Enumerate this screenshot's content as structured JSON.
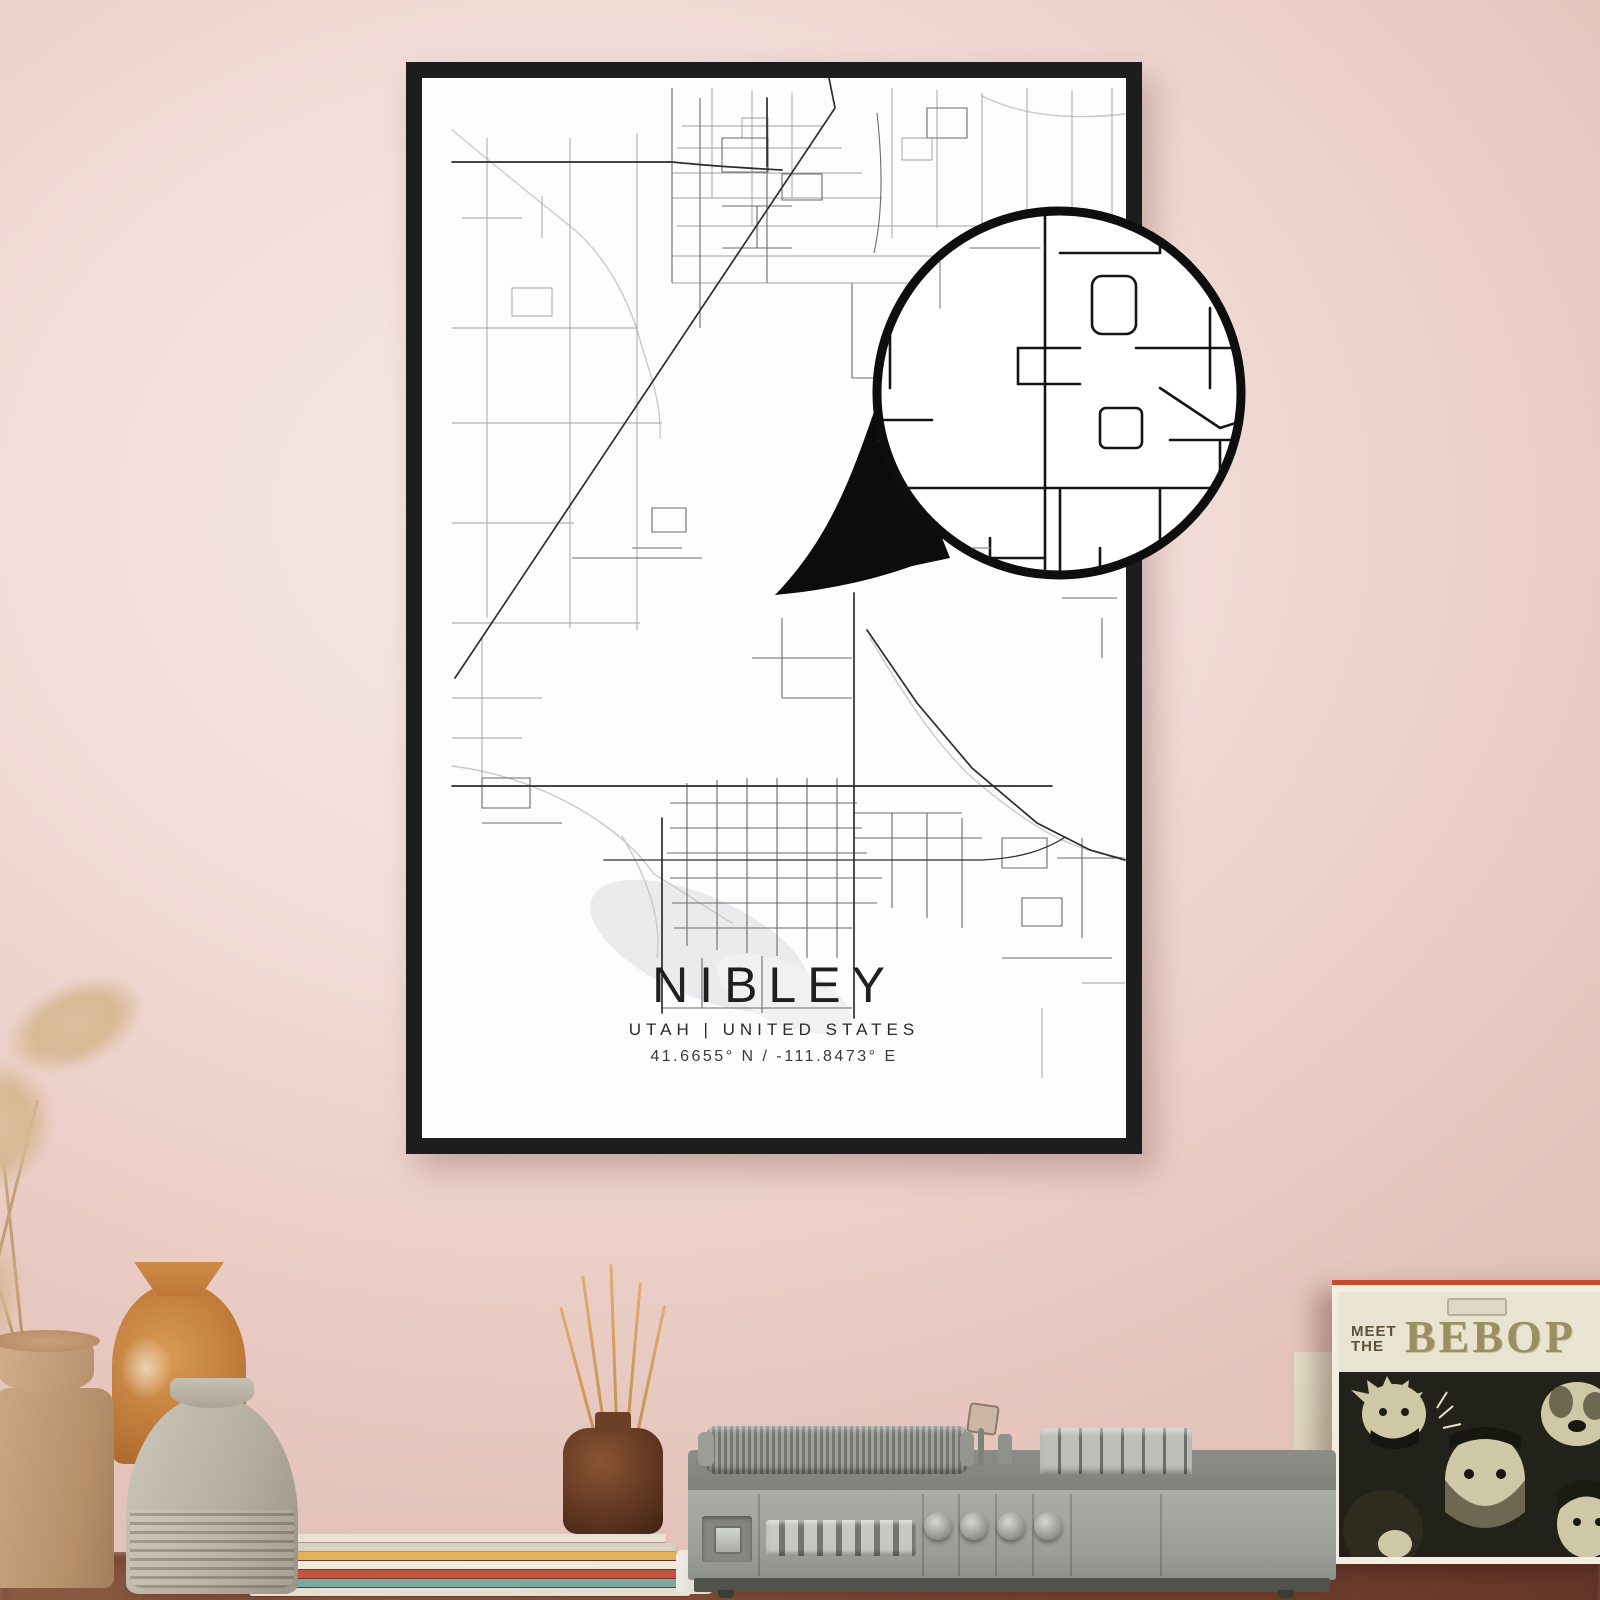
{
  "poster": {
    "title": "NIBLEY",
    "subtitle": "UTAH | UNITED STATES",
    "coordinates": "41.6655° N / -111.8473° E"
  },
  "album": {
    "title_top_line1": "MEET",
    "title_top_line2": "THE",
    "title_main": "BEBOP"
  },
  "colors": {
    "wall": "#f2ddd8",
    "frame": "#1c1d1e",
    "poster_bg": "#fdfdfd",
    "road_dark": "#2d2d2d",
    "road_mid": "#6b6b6b",
    "road_light": "#9e9e9e",
    "water": "#c7cbc8",
    "lake": "#ebebee",
    "table": "#7c4733",
    "player_body": "#9b9d97",
    "album_band": "#e9e4d2",
    "album_text": "#9a8f60",
    "album_accent_strip": "#c24b2e"
  }
}
